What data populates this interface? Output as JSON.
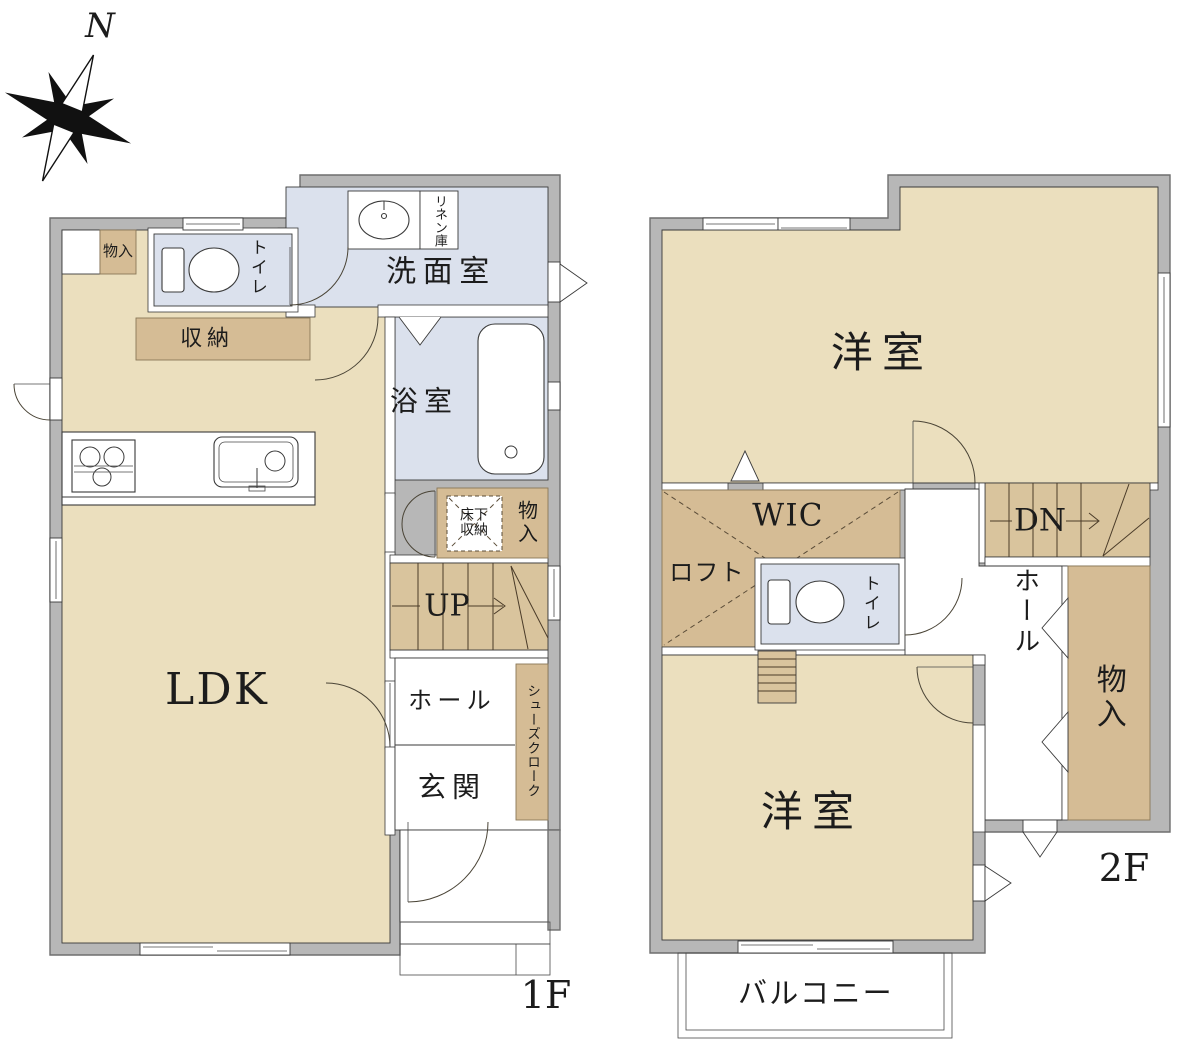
{
  "palette": {
    "wall": "#b7b7b7",
    "wall_stroke": "#6f6f6f",
    "floor": "#ebdfbe",
    "closet": "#d5bc95",
    "stairs": "#d9c49d",
    "wet": "#dbe1ed",
    "paper": "#ffffff",
    "line": "#3a3a3a",
    "label": "#1c1c1c"
  },
  "compass": {
    "north_label": "N"
  },
  "floor1": {
    "floor_label": "1F",
    "rooms": {
      "ldk": "LDK",
      "storage_nook": "物入",
      "toilet": "トイレ",
      "closet": "収納",
      "washroom": "洗面室",
      "linen_closet": "リネン庫",
      "bathroom": "浴室",
      "underfloor_storage_line1": "床下",
      "underfloor_storage_line2": "収納",
      "storage": "物入",
      "stairs_up": "UP",
      "hall": "ホール",
      "entrance": "玄関",
      "shoe_closet": "シューズクローク"
    }
  },
  "floor2": {
    "floor_label": "2F",
    "rooms": {
      "bedroom_upper": "洋室",
      "wic": "WIC",
      "loft": "ロフト",
      "toilet": "トイレ",
      "stairs_down": "DN",
      "hall": "ホール",
      "storage": "物入",
      "bedroom_lower": "洋室",
      "balcony": "バルコニー"
    }
  }
}
